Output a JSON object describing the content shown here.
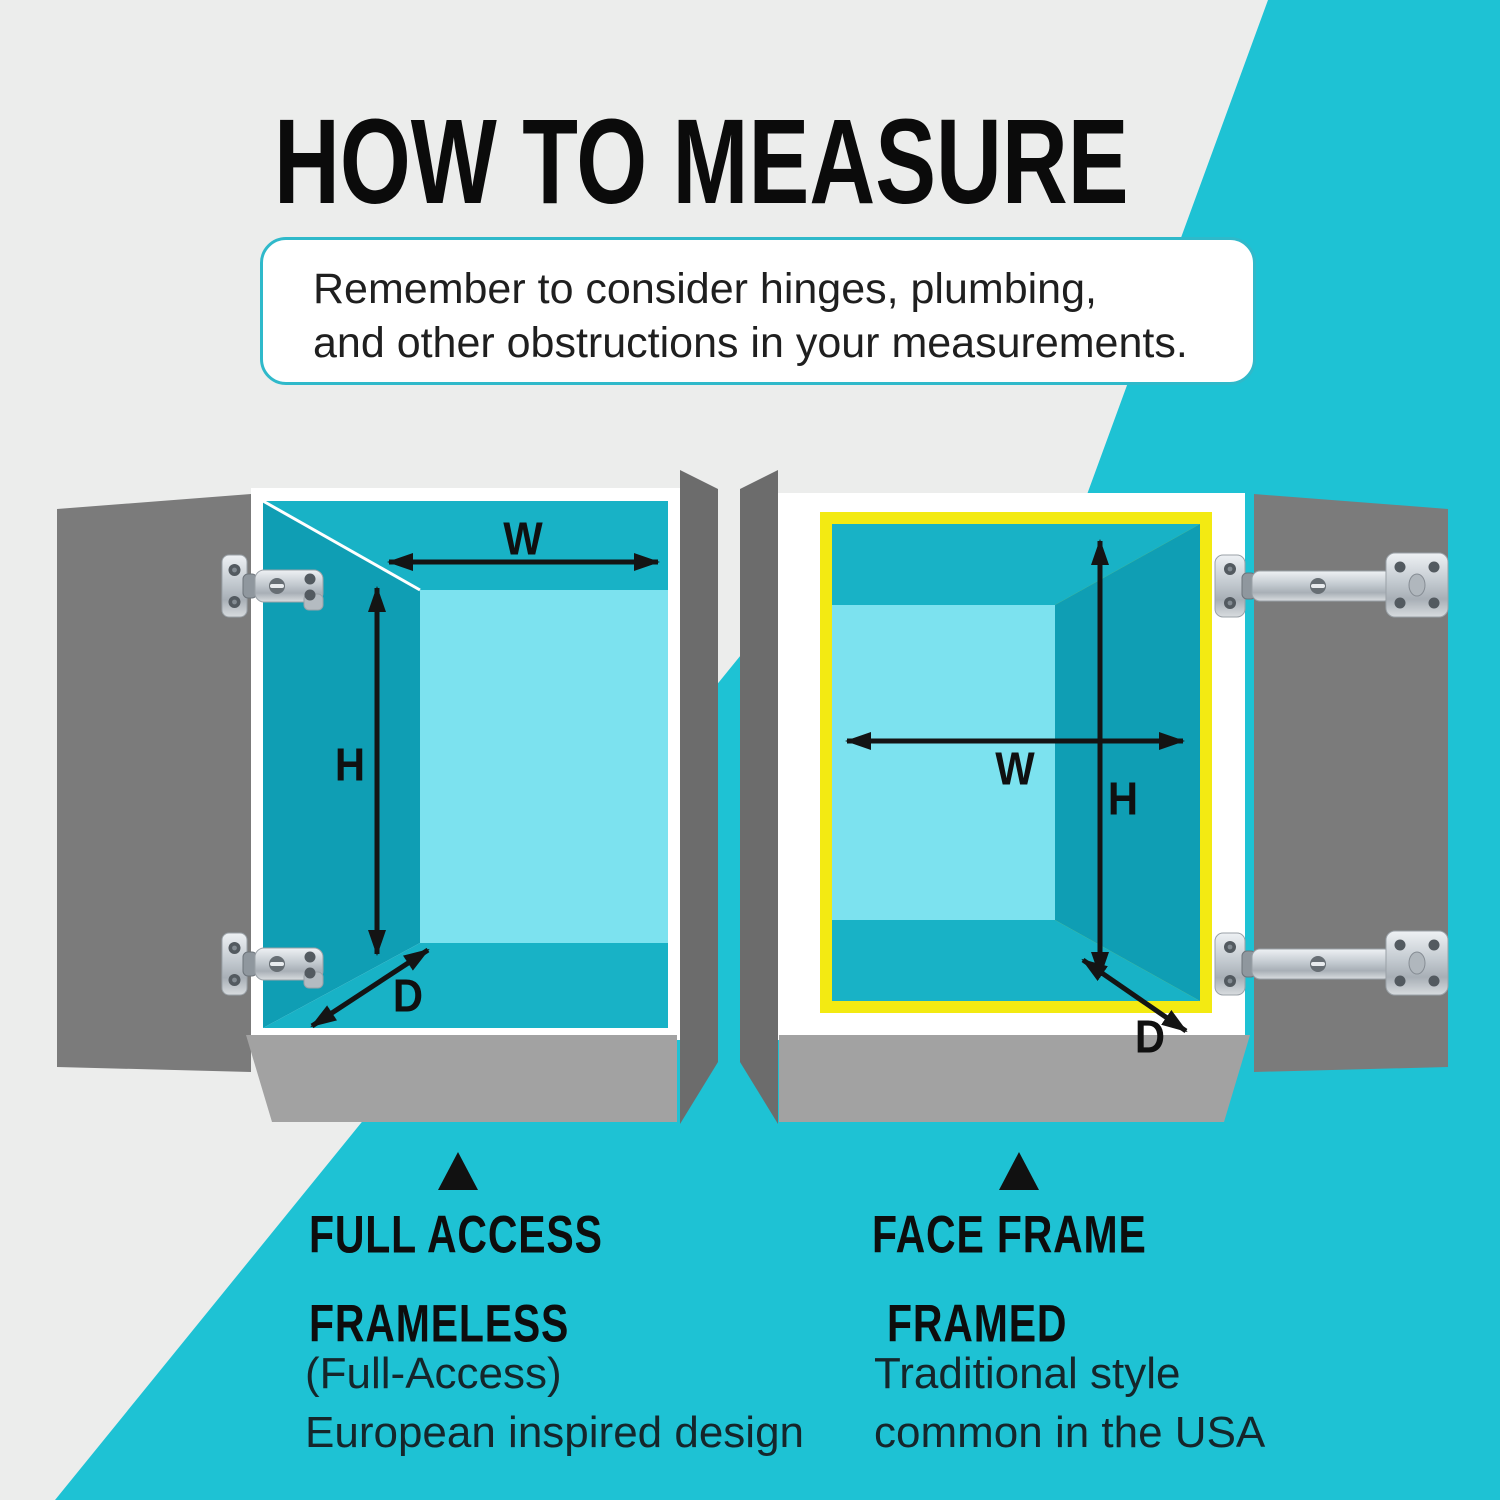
{
  "title": "HOW TO MEASURE",
  "note": {
    "line1": "Remember to consider hinges, plumbing,",
    "line2": "and other obstructions in your measurements."
  },
  "dimensions": {
    "left": {
      "w": "W",
      "h": "H",
      "d": "D"
    },
    "right": {
      "w": "W",
      "h": "H",
      "d": "D"
    }
  },
  "columns": {
    "left": {
      "heading": "FULL ACCESS",
      "type": "FRAMELESS",
      "desc1": "(Full-Access)",
      "desc2": "European inspired design"
    },
    "right": {
      "heading": "FACE FRAME",
      "type": "FRAMED",
      "desc1": "Traditional style",
      "desc2": "common in the USA"
    }
  },
  "icons": {
    "hinge": "cabinet-hinge",
    "pointer": "up-triangle"
  },
  "colors": {
    "background_gray": "#ecedec",
    "accent_cyan": "#1ec2d4",
    "frame_yellow": "#f3ea12",
    "door_gray": "#7b7b7b",
    "side_panel_gray": "#6c6c6c",
    "pedestal_gray": "#a2a2a2",
    "interior_wall_teal": "#0f9eb4",
    "interior_ceiling_teal": "#18b2c6",
    "interior_back_cyan": "#7ce2ef",
    "note_border": "#2fb9ca",
    "text_black": "#0e0e0e"
  }
}
